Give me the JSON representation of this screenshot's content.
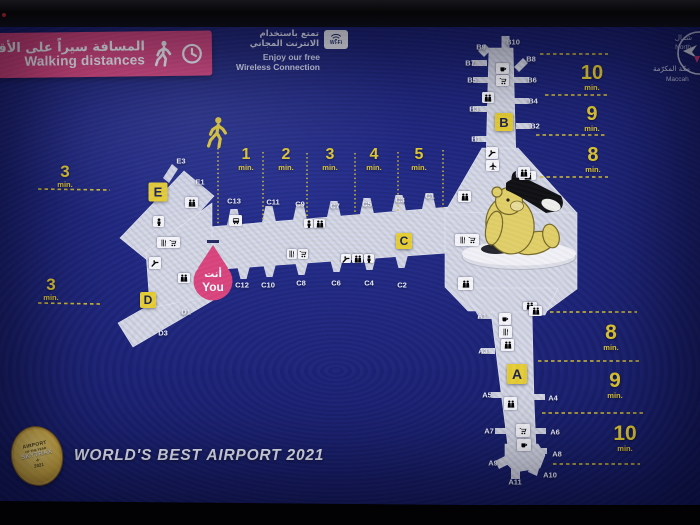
{
  "banner": {
    "title_ar": "المسافة سيراً على الأقدام",
    "title_en": "Walking distances"
  },
  "wifi": {
    "ar_line1": "تمتع باستخدام",
    "ar_line2": "الانترنت المجاني",
    "en_line1": "Enjoy our free",
    "en_line2": "Wireless Connection",
    "badge_label": "Wi-Fi"
  },
  "compass": {
    "north_ar": "شمال",
    "north_en": "North",
    "mecca_ar": "مكة المكرّمة",
    "mecca_en": "Maccah"
  },
  "you_marker": {
    "ar": "أنت",
    "en": "You"
  },
  "concourses": {
    "a": "A",
    "b": "B",
    "c": "C",
    "d": "D",
    "e": "E"
  },
  "gates": {
    "c_top": [
      "C13",
      "C11",
      "C9",
      "C7",
      "C5",
      "C3",
      "C1"
    ],
    "c_bottom": [
      "C12",
      "C10",
      "C8",
      "C6",
      "C4",
      "C2"
    ],
    "e": [
      "E3",
      "E1"
    ],
    "d": [
      "D1",
      "D3"
    ],
    "b_left": [
      "B9",
      "B7",
      "B5",
      "B3",
      "B1"
    ],
    "b_right": [
      "B10",
      "B8",
      "B6",
      "B4",
      "B2"
    ],
    "a_left": [
      "A1",
      "A3",
      "A5",
      "A7",
      "A9"
    ],
    "a_bottom": [
      "A11",
      "A10"
    ],
    "a_right": [
      "A4",
      "A6",
      "A8"
    ]
  },
  "walk_times": {
    "unit": "min.",
    "c_zones": [
      "1",
      "2",
      "3",
      "4",
      "5"
    ],
    "e": "3",
    "d": "3",
    "b_zones": [
      "10",
      "9",
      "8"
    ],
    "a_zones": [
      "8",
      "9",
      "10"
    ]
  },
  "footer": {
    "award_title": "WORLD'S BEST AIRPORT 2021",
    "badge": {
      "line1": "AIRPORT",
      "line2": "OF THE YEAR",
      "brand": "SKYTRAX",
      "year": "2021"
    }
  },
  "colors": {
    "accent_pink": "#e0467e",
    "accent_yellow": "#ecd233",
    "terminal_fill": "#dcdee8",
    "background_navy": "#1c2272"
  }
}
